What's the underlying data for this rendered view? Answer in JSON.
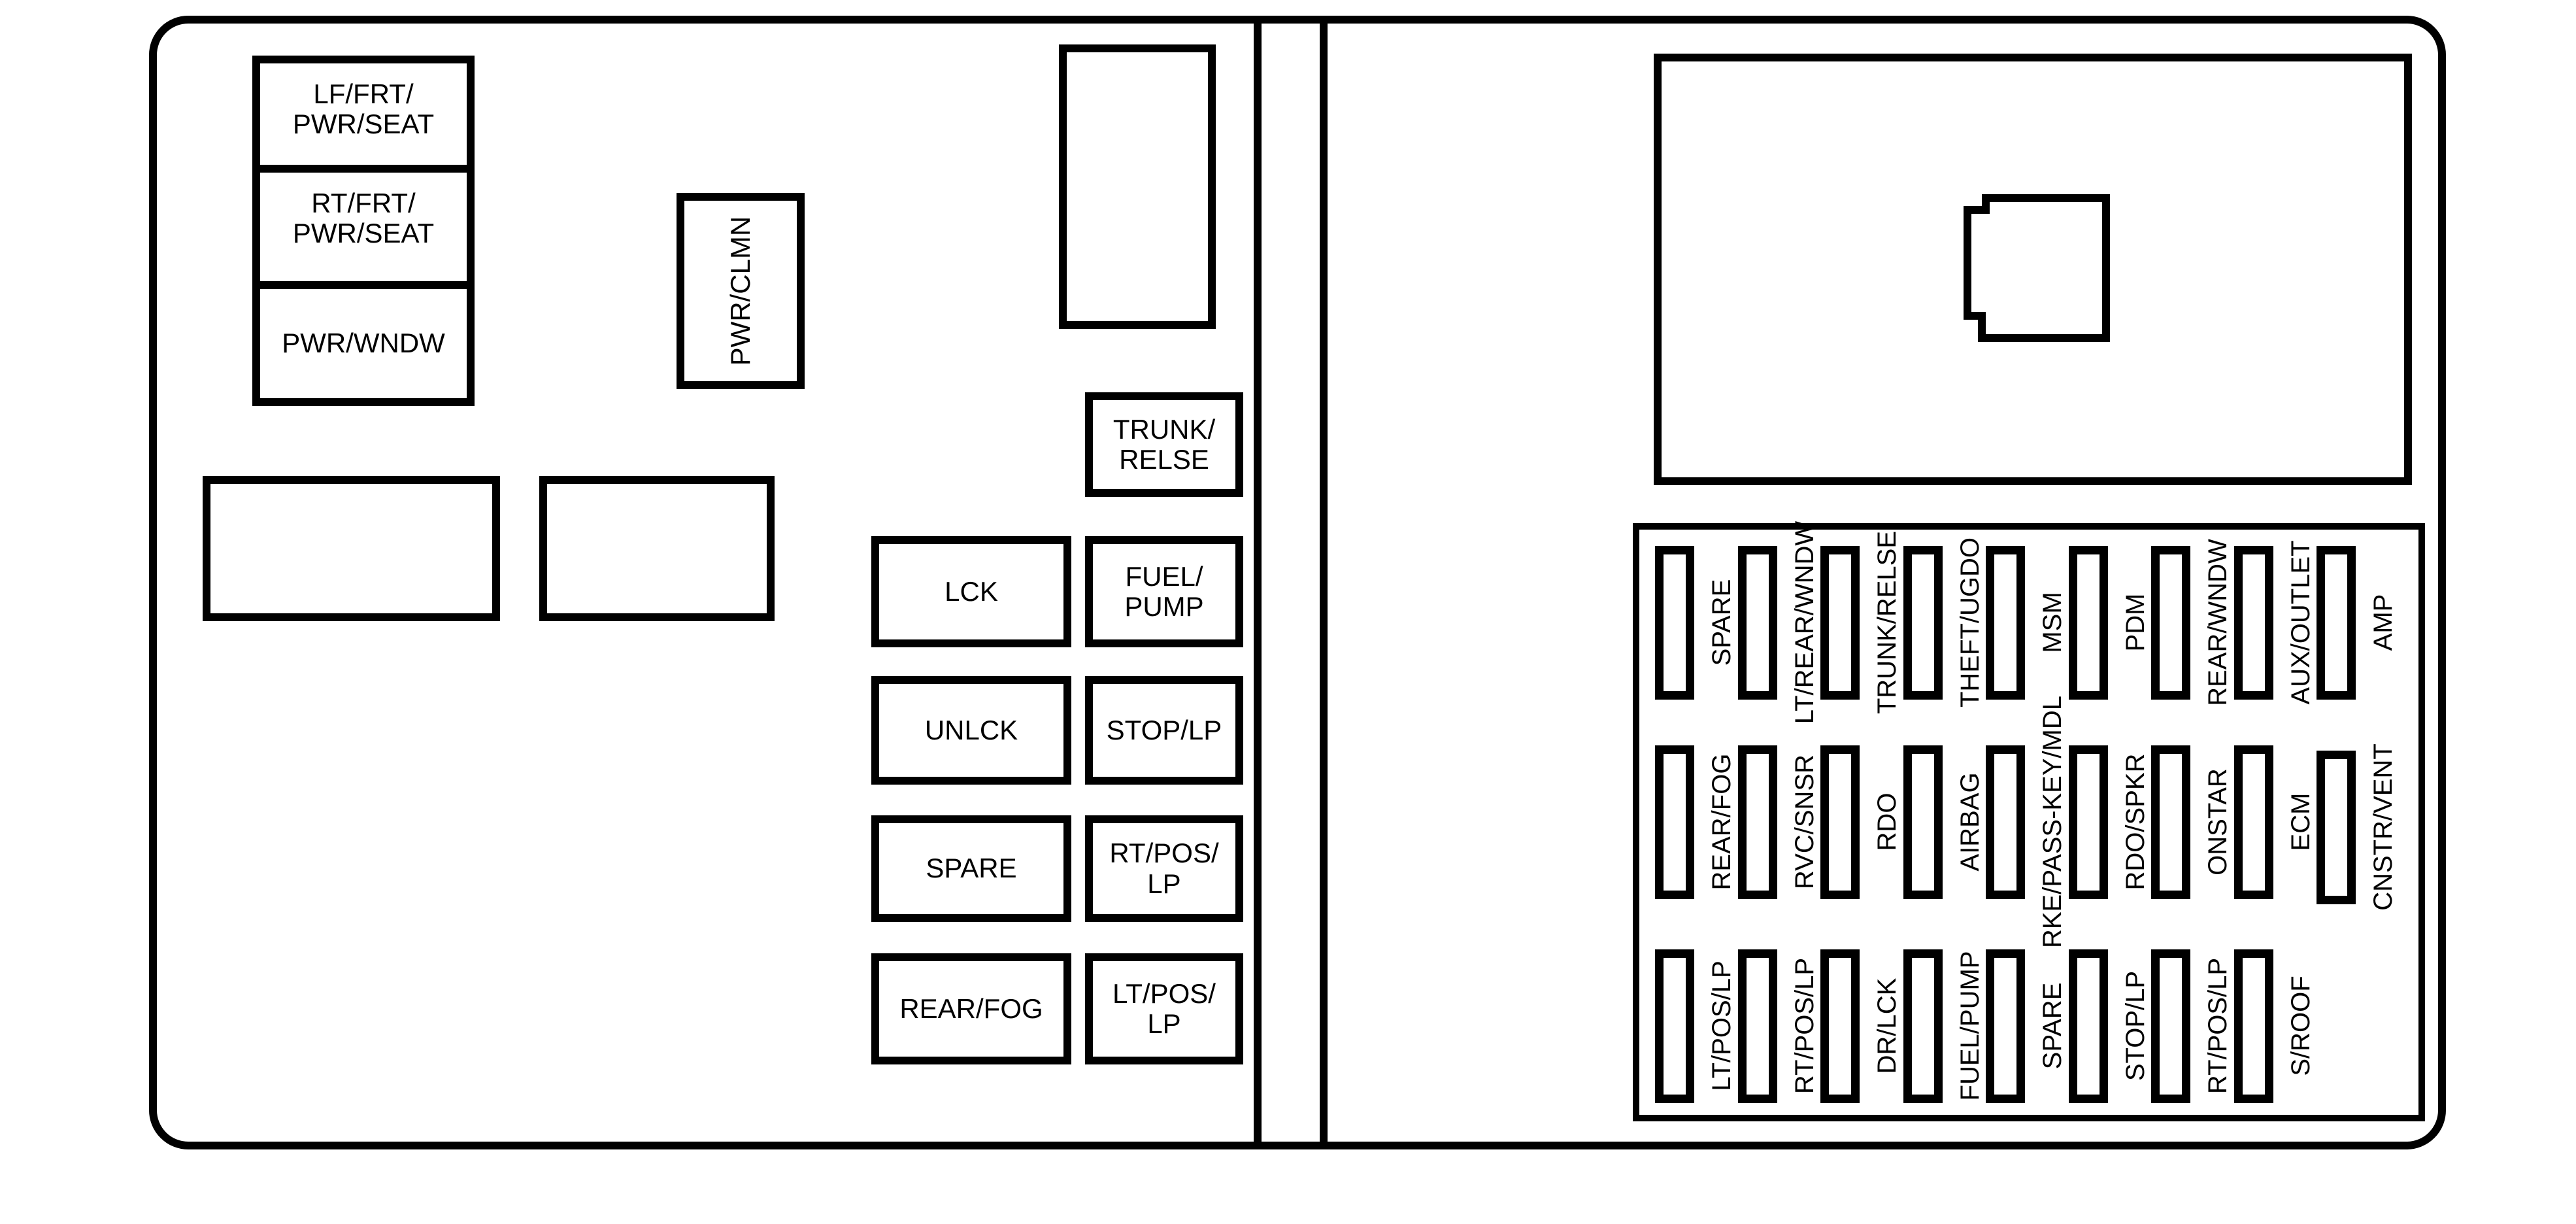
{
  "colors": {
    "line": "#000000",
    "background": "#ffffff"
  },
  "left_panel": {
    "boxes": {
      "lf_frt_pwr_seat": "LF/FRT/\nPWR/SEAT",
      "rt_frt_pwr_seat": "RT/FRT/\nPWR/SEAT",
      "pwr_wndw": "PWR/WNDW",
      "pwr_clmn": "PWR/CLMN",
      "lck": "LCK",
      "unlck": "UNLCK",
      "spare": "SPARE",
      "rear_fog": "REAR/FOG",
      "trunk_relse": "TRUNK/\nRELSE",
      "fuel_pump": "FUEL/\nPUMP",
      "stop_lp": "STOP/LP",
      "rt_pos_lp": "RT/POS/\nLP",
      "lt_pos_lp": "LT/POS/\nLP"
    }
  },
  "right_panel": {
    "fuse_rows": [
      {
        "labels": [
          "SPARE",
          "LT/REAR/WNDW",
          "TRUNK/RELSE",
          "THEFT/UGDO",
          "MSM",
          "PDM",
          "REAR/WNDW",
          "AUX/OUTLET",
          "AMP"
        ]
      },
      {
        "labels": [
          "REAR/FOG",
          "RVC/SNSR",
          "RDO",
          "AIRBAG",
          "RKE/PASS-KEY/MDL",
          "RDO/SPKR",
          "ONSTAR",
          "ECM",
          "CNSTR/VENT"
        ]
      },
      {
        "labels": [
          "LT/POS/LP",
          "RT/POS/LP",
          "DR/LCK",
          "FUEL/PUMP",
          "SPARE",
          "STOP/LP",
          "RT/POS/LP",
          "S/ROOF"
        ]
      }
    ]
  }
}
